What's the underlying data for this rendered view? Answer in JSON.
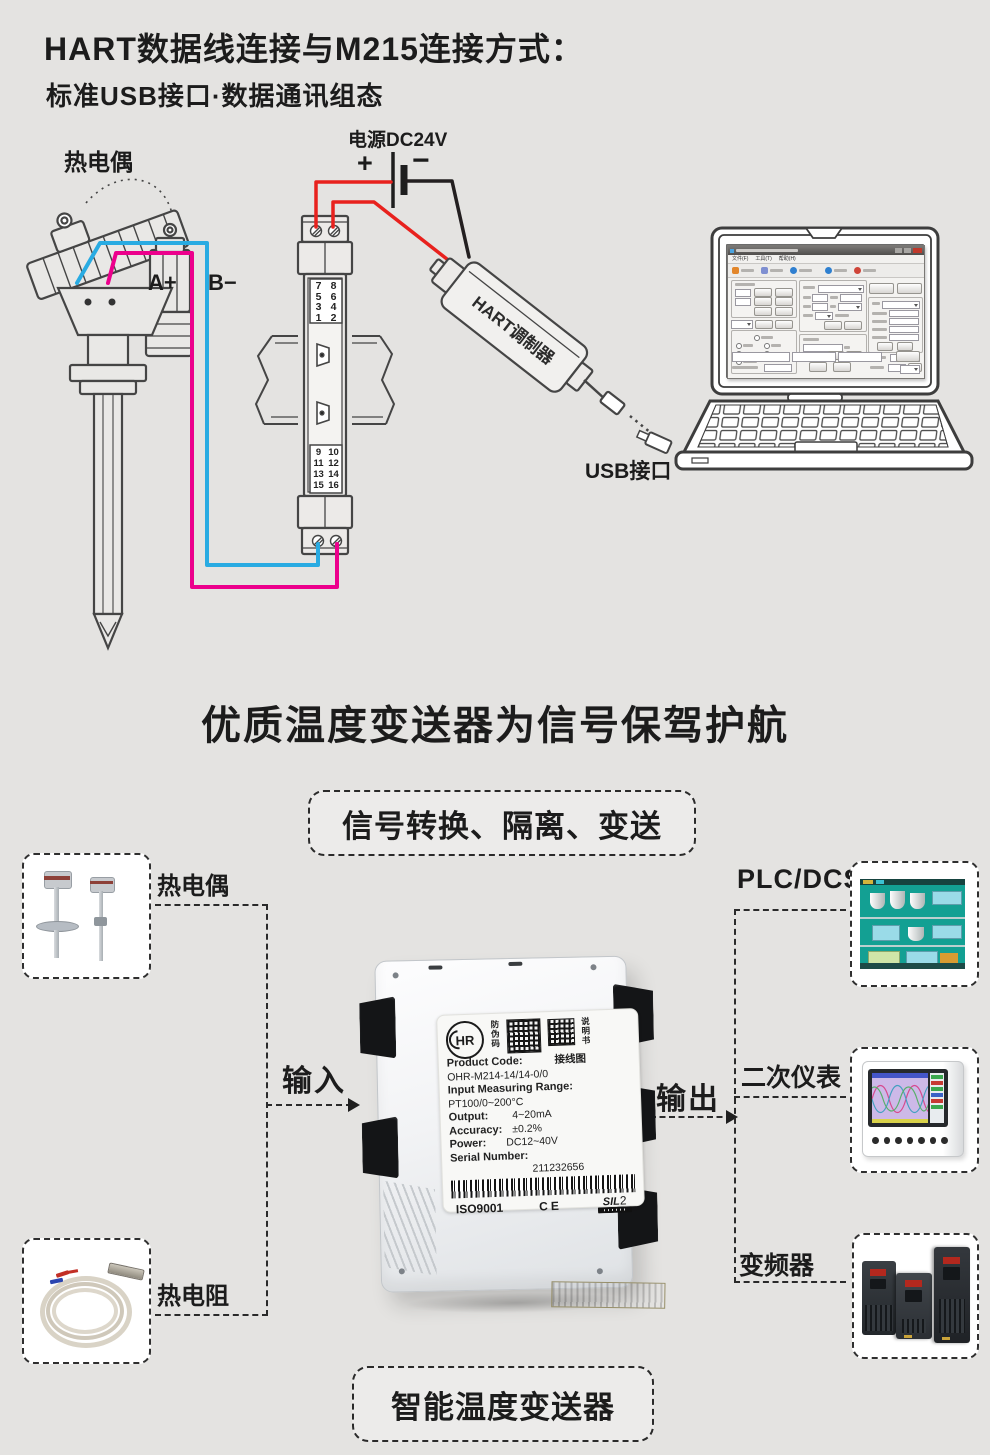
{
  "header": {
    "title": "HART数据线连接与M215连接方式：",
    "subtitle": "标准USB接口·数据通讯组态"
  },
  "diagram": {
    "sensor_label": "热电偶",
    "terminal_a": "A+",
    "terminal_b": "B−",
    "power_label": "电源DC24V",
    "power_plus": "+",
    "power_minus": "−",
    "module_top_terminals": [
      "7",
      "8",
      "5",
      "6",
      "3",
      "4",
      "1",
      "2"
    ],
    "module_bottom_terminals": [
      "9",
      "10",
      "11",
      "12",
      "13",
      "14",
      "15",
      "16"
    ],
    "modulator_label": "HART调制器",
    "usb_label": "USB接口",
    "software_menu": [
      "文件(F)",
      "工具(T)",
      "帮助(H)"
    ]
  },
  "section": {
    "title": "优质温度变送器为信号保驾护航",
    "banner": "信号转换、隔离、变送",
    "input_label": "输入",
    "output_label": "输出",
    "footer_badge": "智能温度变送器"
  },
  "sources": [
    {
      "label": "热电偶"
    },
    {
      "label": "热电阻"
    }
  ],
  "destinations": [
    {
      "label": "PLC/DCS"
    },
    {
      "label": "二次仪表"
    },
    {
      "label": "变频器"
    }
  ],
  "product_label": {
    "brand": "HR",
    "antifake": "防伪码",
    "manual": "说明书",
    "wiring_diagram": "接线图",
    "code_label": "Product Code:",
    "code_value": "OHR-M214-14/14-0/0",
    "range_label": "Input Measuring Range:",
    "range_value": "PT100/0~200°C",
    "output_label": "Output:",
    "output_value": "4~20mA",
    "accuracy_label": "Accuracy:",
    "accuracy_value": "±0.2%",
    "power_label": "Power:",
    "power_value": "DC12~40V",
    "serial_label": "Serial Number:",
    "serial_value": "211232656",
    "cert_iso": "ISO9001",
    "cert_ce": "CE",
    "cert_sil": "SIL",
    "cert_sil_level": "2"
  },
  "colors": {
    "background": "#e4e3e1",
    "wire_red": "#e8211d",
    "wire_black": "#231f20",
    "wire_blue": "#29abe2",
    "wire_magenta": "#ec008c"
  }
}
